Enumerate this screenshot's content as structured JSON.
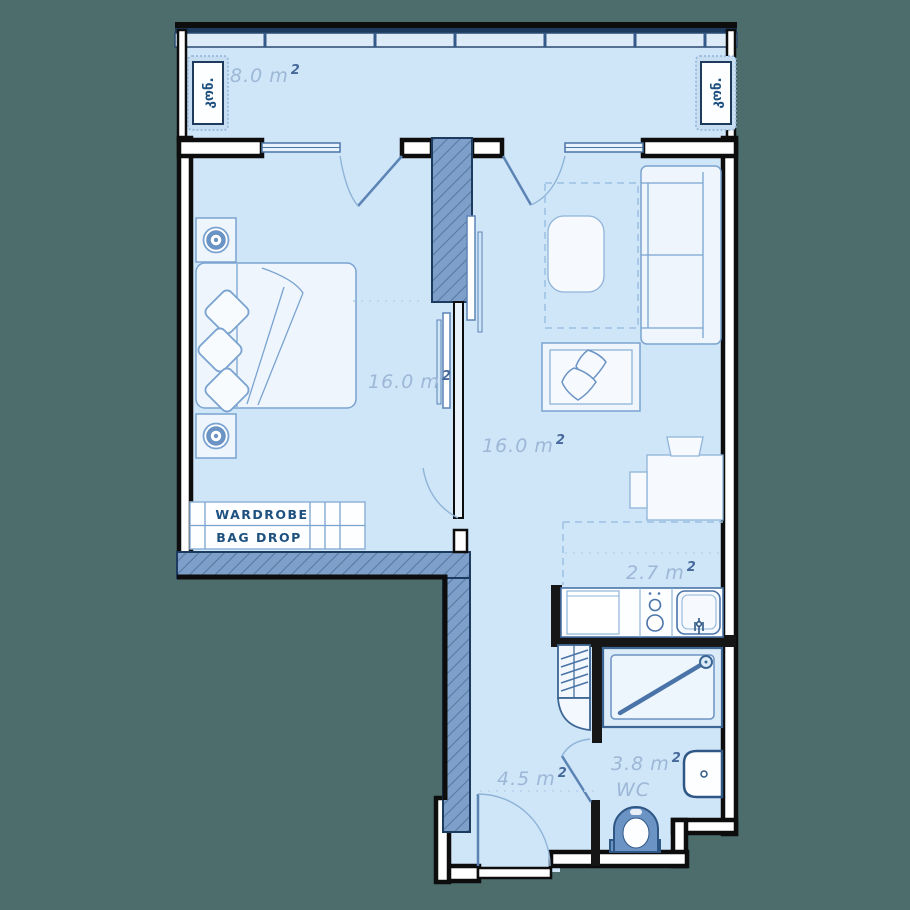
{
  "plan": {
    "type": "apartment-floor-plan",
    "colors": {
      "background": "#4d6d6d",
      "floor": "#cfe5f8",
      "wall_fill": "#ffffff",
      "wall_outline": "#0d0d0d",
      "hatched_wall": "#7d9fc9",
      "hatch_line": "#54789f",
      "furniture_line": "#7aa3d0",
      "furniture_fill": "#eef5fd",
      "area_label": "#9db7d6",
      "area_sup": "#46699b",
      "dark_text": "#1e517f",
      "window_frame": "#1d3a5f"
    }
  },
  "rooms": {
    "balcony": {
      "area": "8.0",
      "unit": "m",
      "sup": "2"
    },
    "bedroom": {
      "area": "16.0",
      "unit": "m",
      "sup": "2"
    },
    "living": {
      "area": "16.0",
      "unit": "m",
      "sup": "2"
    },
    "kitchen": {
      "area": "2.7",
      "unit": "m",
      "sup": "2"
    },
    "hallway": {
      "area": "4.5",
      "unit": "m",
      "sup": "2"
    },
    "bathroom": {
      "area": "3.8",
      "unit": "m",
      "sup": "2",
      "name": "WC"
    }
  },
  "fixtures": {
    "wardrobe_label": "WARDROBE",
    "bag_drop_label": "BAG DROP",
    "ac_left_label": "კონ.",
    "ac_right_label": "კონ."
  }
}
